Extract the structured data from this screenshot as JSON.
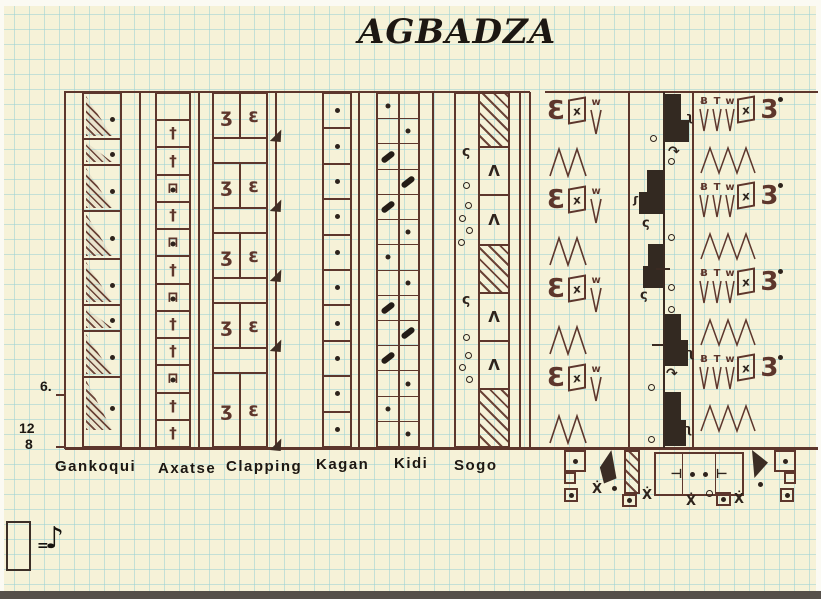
{
  "title": "AGBADZA",
  "meta": {
    "measure_marker": "6.",
    "time_sig_top": "12",
    "time_sig_bottom": "8"
  },
  "legend": {
    "equals_sign": "=",
    "eighth_note": "♪"
  },
  "instruments": {
    "gankoqui": "Gankoqui",
    "axatse": "Axatse",
    "clapping": "Clapping",
    "kagan": "Kagan",
    "kidi": "Kidi",
    "sogo": "Sogo"
  },
  "glyphs": {
    "cross": "†",
    "rattle_arch": "⊓",
    "dot": "•",
    "circle": "o",
    "clap_left": "ʒ",
    "clap_right": "ɛ",
    "squiggle": "ς",
    "accent": "Λ",
    "w_mark": "w",
    "x_mark": "x",
    "t_mark": "T",
    "b_flag": "Ƀ",
    "e_arc": "Ɛ",
    "turn": "↷",
    "hook": "ʅ",
    "tick_left": "⊣",
    "tick_right": "⊢",
    "x_dot": "Ẋ"
  },
  "patterns": {
    "gankoqui_durations_in_eighths": [
      1.5,
      1,
      1.5,
      1.5,
      1.5,
      1,
      1.5,
      1.5
    ],
    "axatse_cells": [
      "rest",
      "up",
      "up",
      "down",
      "up",
      "down",
      "up",
      "down",
      "up",
      "up",
      "down",
      "up",
      "up"
    ],
    "clapping_claps": 5,
    "kagan_strokes": 10,
    "kidi_cells": [
      "open",
      "open",
      "mute",
      "mute",
      "mute",
      "open",
      "open",
      "open",
      "mute",
      "mute",
      "mute",
      "open",
      "open",
      "open"
    ],
    "sogo_right_cells": [
      "hatch",
      "accent",
      "accent",
      "hatch",
      "accent",
      "accent",
      "hatch"
    ],
    "timeline_blocks": 5,
    "right_units_col_a": 4,
    "right_units_col_c": 4
  },
  "colors": {
    "ink": "#5d362c",
    "ink_dark": "#2e231c",
    "paper": "#f6f2d8",
    "grid_line": "#7dc6d4"
  }
}
